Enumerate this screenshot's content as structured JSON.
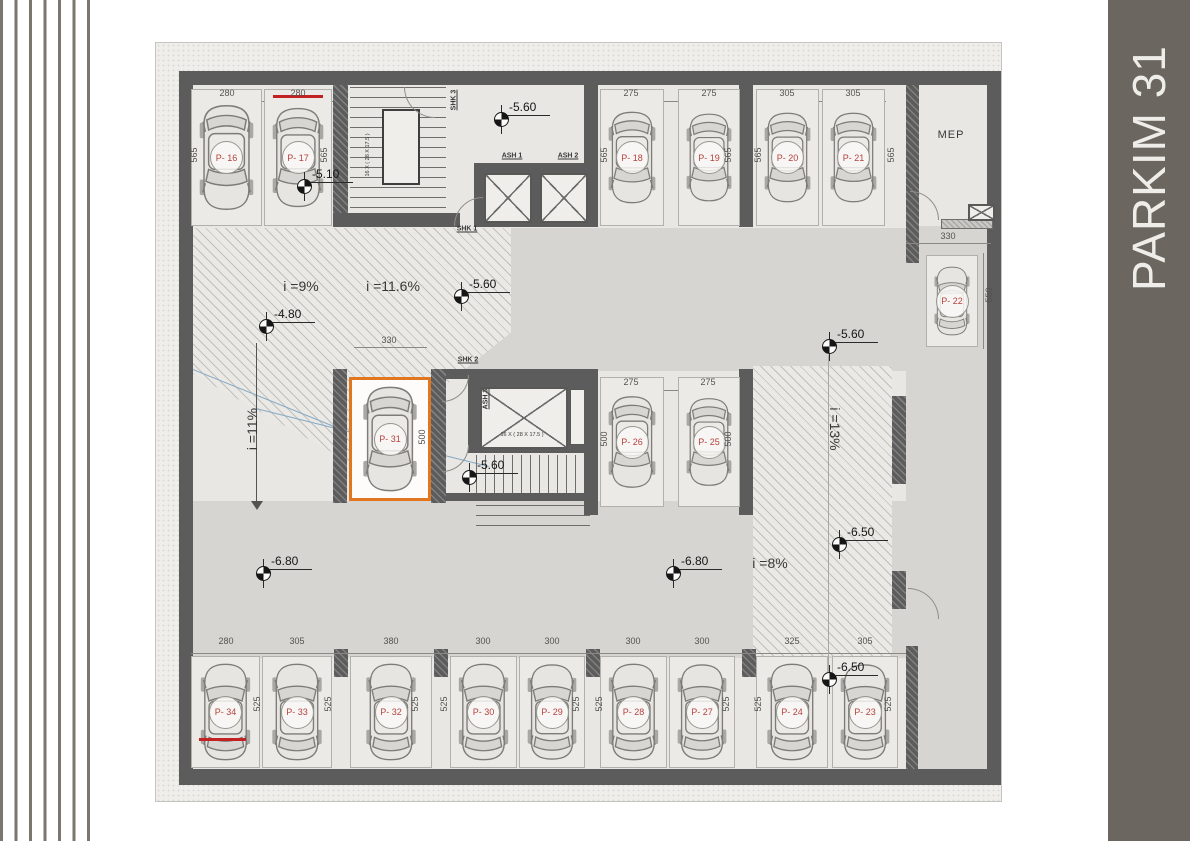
{
  "side_panel": {
    "title": "PARKIM 31",
    "bg_color": "#6b665f",
    "text_color": "#efede9"
  },
  "decoration": {
    "left_line_color": "#7b766e"
  },
  "plan": {
    "accent_highlight_color": "#e0761f",
    "spot_label_color": "#b2423e",
    "room_labels": [
      {
        "name": "mep-room-label",
        "text": "MEP",
        "x": 795,
        "y": 92
      }
    ],
    "core_labels": [
      {
        "name": "elevator-ash1-label",
        "text": "ASH 1",
        "x": 356,
        "y": 113,
        "vertical": false
      },
      {
        "name": "elevator-ash2-label",
        "text": "ASH 2",
        "x": 412,
        "y": 113,
        "vertical": false
      },
      {
        "name": "elevator-ash3-label",
        "text": "ASH 3",
        "x": 330,
        "y": 356,
        "vertical": true
      },
      {
        "name": "stair-shk1-label",
        "text": "SHK 1",
        "x": 311,
        "y": 186,
        "vertical": false
      },
      {
        "name": "stair-shk2-label",
        "text": "SHK 2",
        "x": 312,
        "y": 317,
        "vertical": false
      },
      {
        "name": "stair-shk3-label",
        "text": "SHK 3",
        "x": 298,
        "y": 57,
        "vertical": true
      }
    ],
    "stair_notes": [
      {
        "text": "16 X ( 28 X 17.5 )",
        "x": 212,
        "y": 112,
        "vertical": true
      },
      {
        "text": "16 X ( 28 X 17.5 )",
        "x": 366,
        "y": 392,
        "vertical": false
      }
    ],
    "slope_labels": [
      {
        "text": "i =9%",
        "x": 145,
        "y": 243,
        "orient": "h"
      },
      {
        "text": "i =11.6%",
        "x": 237,
        "y": 243,
        "orient": "h"
      },
      {
        "text": "i =11%",
        "x": 96,
        "y": 386,
        "orient": "v-up"
      },
      {
        "text": "i =13%",
        "x": 679,
        "y": 386,
        "orient": "v-down"
      },
      {
        "text": "i =8%",
        "x": 614,
        "y": 520,
        "orient": "h"
      }
    ],
    "level_markers": [
      {
        "value": "-5.10",
        "x": 148,
        "y": 143
      },
      {
        "value": "-5.60",
        "x": 345,
        "y": 76
      },
      {
        "value": "-5.60",
        "x": 305,
        "y": 253
      },
      {
        "value": "-5.60",
        "x": 673,
        "y": 303
      },
      {
        "value": "-5.60",
        "x": 313,
        "y": 434
      },
      {
        "value": "-4.80",
        "x": 110,
        "y": 283
      },
      {
        "value": "-6.80",
        "x": 107,
        "y": 530
      },
      {
        "value": "-6.80",
        "x": 517,
        "y": 530
      },
      {
        "value": "-6.50",
        "x": 683,
        "y": 501
      },
      {
        "value": "-6.50",
        "x": 673,
        "y": 636
      }
    ],
    "parking_spots": [
      {
        "label": "P- 16",
        "x": 35,
        "y": 46,
        "w": 71,
        "h": 137,
        "orient": "down"
      },
      {
        "label": "P- 17",
        "x": 108,
        "y": 46,
        "w": 68,
        "h": 137,
        "orient": "down",
        "mark": "red-top"
      },
      {
        "label": "P- 18",
        "x": 444,
        "y": 46,
        "w": 64,
        "h": 137,
        "orient": "down"
      },
      {
        "label": "P- 19",
        "x": 522,
        "y": 46,
        "w": 62,
        "h": 137,
        "orient": "down"
      },
      {
        "label": "P- 20",
        "x": 600,
        "y": 46,
        "w": 63,
        "h": 137,
        "orient": "down"
      },
      {
        "label": "P- 21",
        "x": 666,
        "y": 46,
        "w": 63,
        "h": 137,
        "orient": "down"
      },
      {
        "label": "P- 22",
        "x": 770,
        "y": 212,
        "w": 52,
        "h": 92,
        "orient": "up"
      },
      {
        "label": "P- 31",
        "x": 193,
        "y": 334,
        "w": 82,
        "h": 124,
        "orient": "down",
        "highlight": true
      },
      {
        "label": "P- 26",
        "x": 444,
        "y": 334,
        "w": 64,
        "h": 130,
        "orient": "down"
      },
      {
        "label": "P- 25",
        "x": 522,
        "y": 334,
        "w": 62,
        "h": 130,
        "orient": "down"
      },
      {
        "label": "P- 34",
        "x": 35,
        "y": 613,
        "w": 69,
        "h": 112,
        "orient": "up",
        "mark": "red-bottom"
      },
      {
        "label": "P- 33",
        "x": 106,
        "y": 613,
        "w": 70,
        "h": 112,
        "orient": "up"
      },
      {
        "label": "P- 32",
        "x": 194,
        "y": 613,
        "w": 82,
        "h": 112,
        "orient": "up"
      },
      {
        "label": "P- 30",
        "x": 294,
        "y": 613,
        "w": 67,
        "h": 112,
        "orient": "up"
      },
      {
        "label": "P- 29",
        "x": 363,
        "y": 613,
        "w": 66,
        "h": 112,
        "orient": "up"
      },
      {
        "label": "P- 28",
        "x": 444,
        "y": 613,
        "w": 67,
        "h": 112,
        "orient": "up"
      },
      {
        "label": "P- 27",
        "x": 513,
        "y": 613,
        "w": 66,
        "h": 112,
        "orient": "up"
      },
      {
        "label": "P- 24",
        "x": 600,
        "y": 613,
        "w": 72,
        "h": 112,
        "orient": "up"
      },
      {
        "label": "P- 23",
        "x": 676,
        "y": 613,
        "w": 66,
        "h": 112,
        "orient": "up"
      }
    ],
    "dim_labels": [
      {
        "text": "280",
        "x": 71,
        "y": 50,
        "vertical": false
      },
      {
        "text": "280",
        "x": 142,
        "y": 50,
        "vertical": false
      },
      {
        "text": "275",
        "x": 475,
        "y": 50,
        "vertical": false
      },
      {
        "text": "275",
        "x": 553,
        "y": 50,
        "vertical": false
      },
      {
        "text": "305",
        "x": 631,
        "y": 50,
        "vertical": false
      },
      {
        "text": "305",
        "x": 697,
        "y": 50,
        "vertical": false
      },
      {
        "text": "275",
        "x": 475,
        "y": 339,
        "vertical": false
      },
      {
        "text": "275",
        "x": 552,
        "y": 339,
        "vertical": false
      },
      {
        "text": "330",
        "x": 233,
        "y": 297,
        "vertical": false
      },
      {
        "text": "330",
        "x": 792,
        "y": 193,
        "vertical": false
      },
      {
        "text": "280",
        "x": 70,
        "y": 598,
        "vertical": false
      },
      {
        "text": "305",
        "x": 141,
        "y": 598,
        "vertical": false
      },
      {
        "text": "380",
        "x": 235,
        "y": 598,
        "vertical": false
      },
      {
        "text": "300",
        "x": 327,
        "y": 598,
        "vertical": false
      },
      {
        "text": "300",
        "x": 396,
        "y": 598,
        "vertical": false
      },
      {
        "text": "300",
        "x": 477,
        "y": 598,
        "vertical": false
      },
      {
        "text": "300",
        "x": 546,
        "y": 598,
        "vertical": false
      },
      {
        "text": "325",
        "x": 636,
        "y": 598,
        "vertical": false
      },
      {
        "text": "305",
        "x": 709,
        "y": 598,
        "vertical": false
      },
      {
        "text": "565",
        "x": 38,
        "y": 112,
        "vertical": true
      },
      {
        "text": "565",
        "x": 168,
        "y": 112,
        "vertical": true
      },
      {
        "text": "565",
        "x": 448,
        "y": 112,
        "vertical": true
      },
      {
        "text": "565",
        "x": 572,
        "y": 112,
        "vertical": true
      },
      {
        "text": "565",
        "x": 602,
        "y": 112,
        "vertical": true
      },
      {
        "text": "565",
        "x": 735,
        "y": 112,
        "vertical": true
      },
      {
        "text": "500",
        "x": 266,
        "y": 394,
        "vertical": true
      },
      {
        "text": "500",
        "x": 448,
        "y": 396,
        "vertical": true
      },
      {
        "text": "500",
        "x": 572,
        "y": 396,
        "vertical": true
      },
      {
        "text": "550",
        "x": 833,
        "y": 252,
        "vertical": true
      },
      {
        "text": "525",
        "x": 101,
        "y": 661,
        "vertical": true
      },
      {
        "text": "525",
        "x": 172,
        "y": 661,
        "vertical": true
      },
      {
        "text": "525",
        "x": 259,
        "y": 661,
        "vertical": true
      },
      {
        "text": "525",
        "x": 288,
        "y": 661,
        "vertical": true
      },
      {
        "text": "525",
        "x": 420,
        "y": 661,
        "vertical": true
      },
      {
        "text": "525",
        "x": 443,
        "y": 661,
        "vertical": true
      },
      {
        "text": "525",
        "x": 570,
        "y": 661,
        "vertical": true
      },
      {
        "text": "525",
        "x": 602,
        "y": 661,
        "vertical": true
      },
      {
        "text": "525",
        "x": 732,
        "y": 661,
        "vertical": true
      }
    ]
  }
}
